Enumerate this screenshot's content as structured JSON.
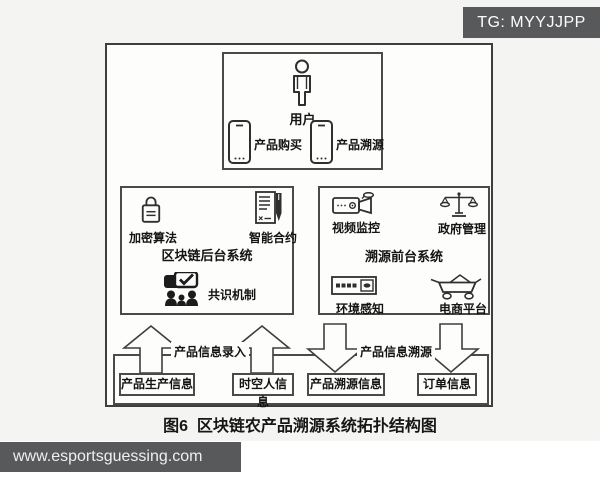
{
  "badge": {
    "text": "TG: MYYJJPP"
  },
  "footer": {
    "text": "www.esportsguessing.com"
  },
  "figure": {
    "caption": "图6  区块链农产品溯源系统拓扑结构图"
  },
  "user_box": {
    "user_label": "用户",
    "purchase_label": "产品购买",
    "trace_label": "产品溯源"
  },
  "backend_box": {
    "title": "区块链后台系统",
    "encryption_label": "加密算法",
    "contract_label": "智能合约",
    "consensus_label": "共识机制"
  },
  "frontend_box": {
    "title": "溯源前台系统",
    "video_label": "视频监控",
    "government_label": "政府管理",
    "environment_label": "环境感知",
    "ecommerce_label": "电商平台"
  },
  "flow": {
    "entry_label": "产品信息录入",
    "trace_label": "产品信息溯源",
    "info_boxes": [
      "产品生产信息",
      "时空人信息",
      "产品溯源信息",
      "订单信息"
    ]
  },
  "colors": {
    "line": "#3e3e3e",
    "watermark_bg": "#58595b",
    "photo_bg": "#f4f4f2"
  }
}
